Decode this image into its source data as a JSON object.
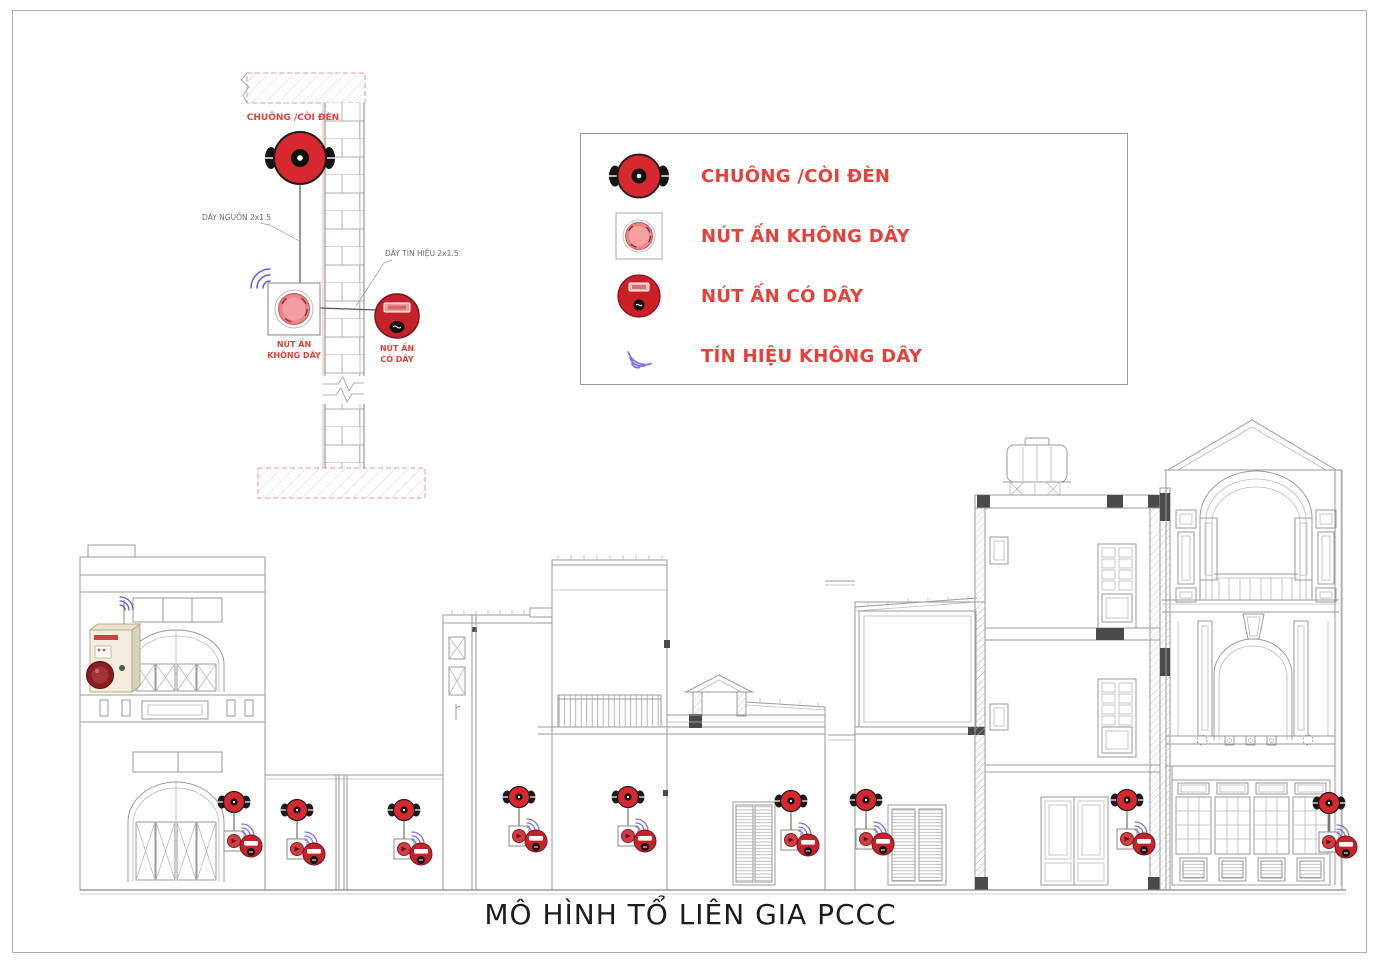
{
  "title": "MÔ HÌNH TỔ LIÊN GIA PCCC",
  "colors": {
    "device_red": "#d7282f",
    "wired_button_red": "#c4232b",
    "label_red": "#e5403a",
    "signal_blue": "#7b74e8",
    "cad_line_gray": "#9a9a9a",
    "panel_beige": "#f4ecdc"
  },
  "wall_detail": {
    "bell_label": "CHUÔNG /CÒI ĐÈN",
    "power_wire_label": "DÂY NGUỒN 2x1.5",
    "signal_wire_label": "DÂY TÍN HIỆU 2x1.5",
    "wireless_button_label": [
      "NÚT ẤN",
      "KHÔNG DÂY"
    ],
    "wired_button_label": [
      "NÚT ẤN",
      "CÓ DÂY"
    ]
  },
  "legend": {
    "items": [
      {
        "icon": "bell-icon",
        "label": "CHUÔNG /CÒI ĐÈN"
      },
      {
        "icon": "wireless-button-icon",
        "label": "NÚT ẤN KHÔNG DÂY"
      },
      {
        "icon": "wired-button-icon",
        "label": "NÚT ẤN CÓ DÂY"
      },
      {
        "icon": "wireless-signal-icon",
        "label": "TÍN HIỆU KHÔNG DÂY"
      }
    ]
  }
}
